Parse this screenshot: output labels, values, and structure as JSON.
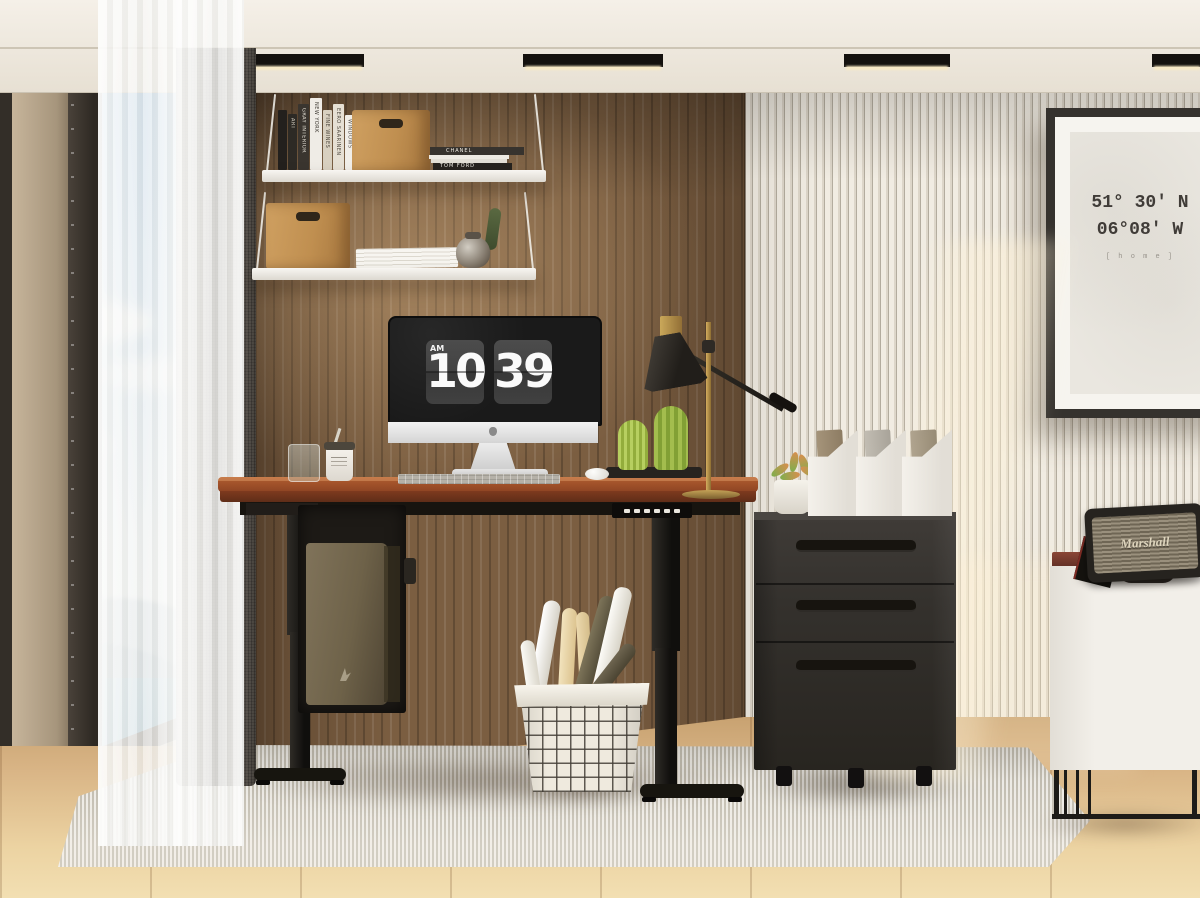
{
  "clock": {
    "meridiem": "AM",
    "hour": "10",
    "minute": "39"
  },
  "poster": {
    "latitude": "51° 30' N",
    "longitude": "06°08' W",
    "caption": "[ h o m e ]"
  },
  "speaker": {
    "brand": "Marshall"
  },
  "shelf_books": {
    "spines": [
      "ART",
      "GRAY INTERIOR",
      "NEW YORK",
      "FINE WINES",
      "EERO SAARINEN",
      "WINDOWS"
    ],
    "stacked": [
      "CHANEL",
      "TOM FORD"
    ]
  },
  "palette": {
    "wood_wall": "#7b5e41",
    "slat_wall": "#e9e3d7",
    "desk_top": "#9c4e28",
    "desk_frame": "#17140f",
    "file_cabinet": "#34312d",
    "rug": "#d6d1c5",
    "floor": "#d9b586",
    "sky": "#7fb2e0",
    "sea": "#5a96b6",
    "curtain": "#6f6860",
    "lamp_brass": "#bb944a",
    "plant_green": "#6d9c43",
    "clock_card": "#424242"
  }
}
